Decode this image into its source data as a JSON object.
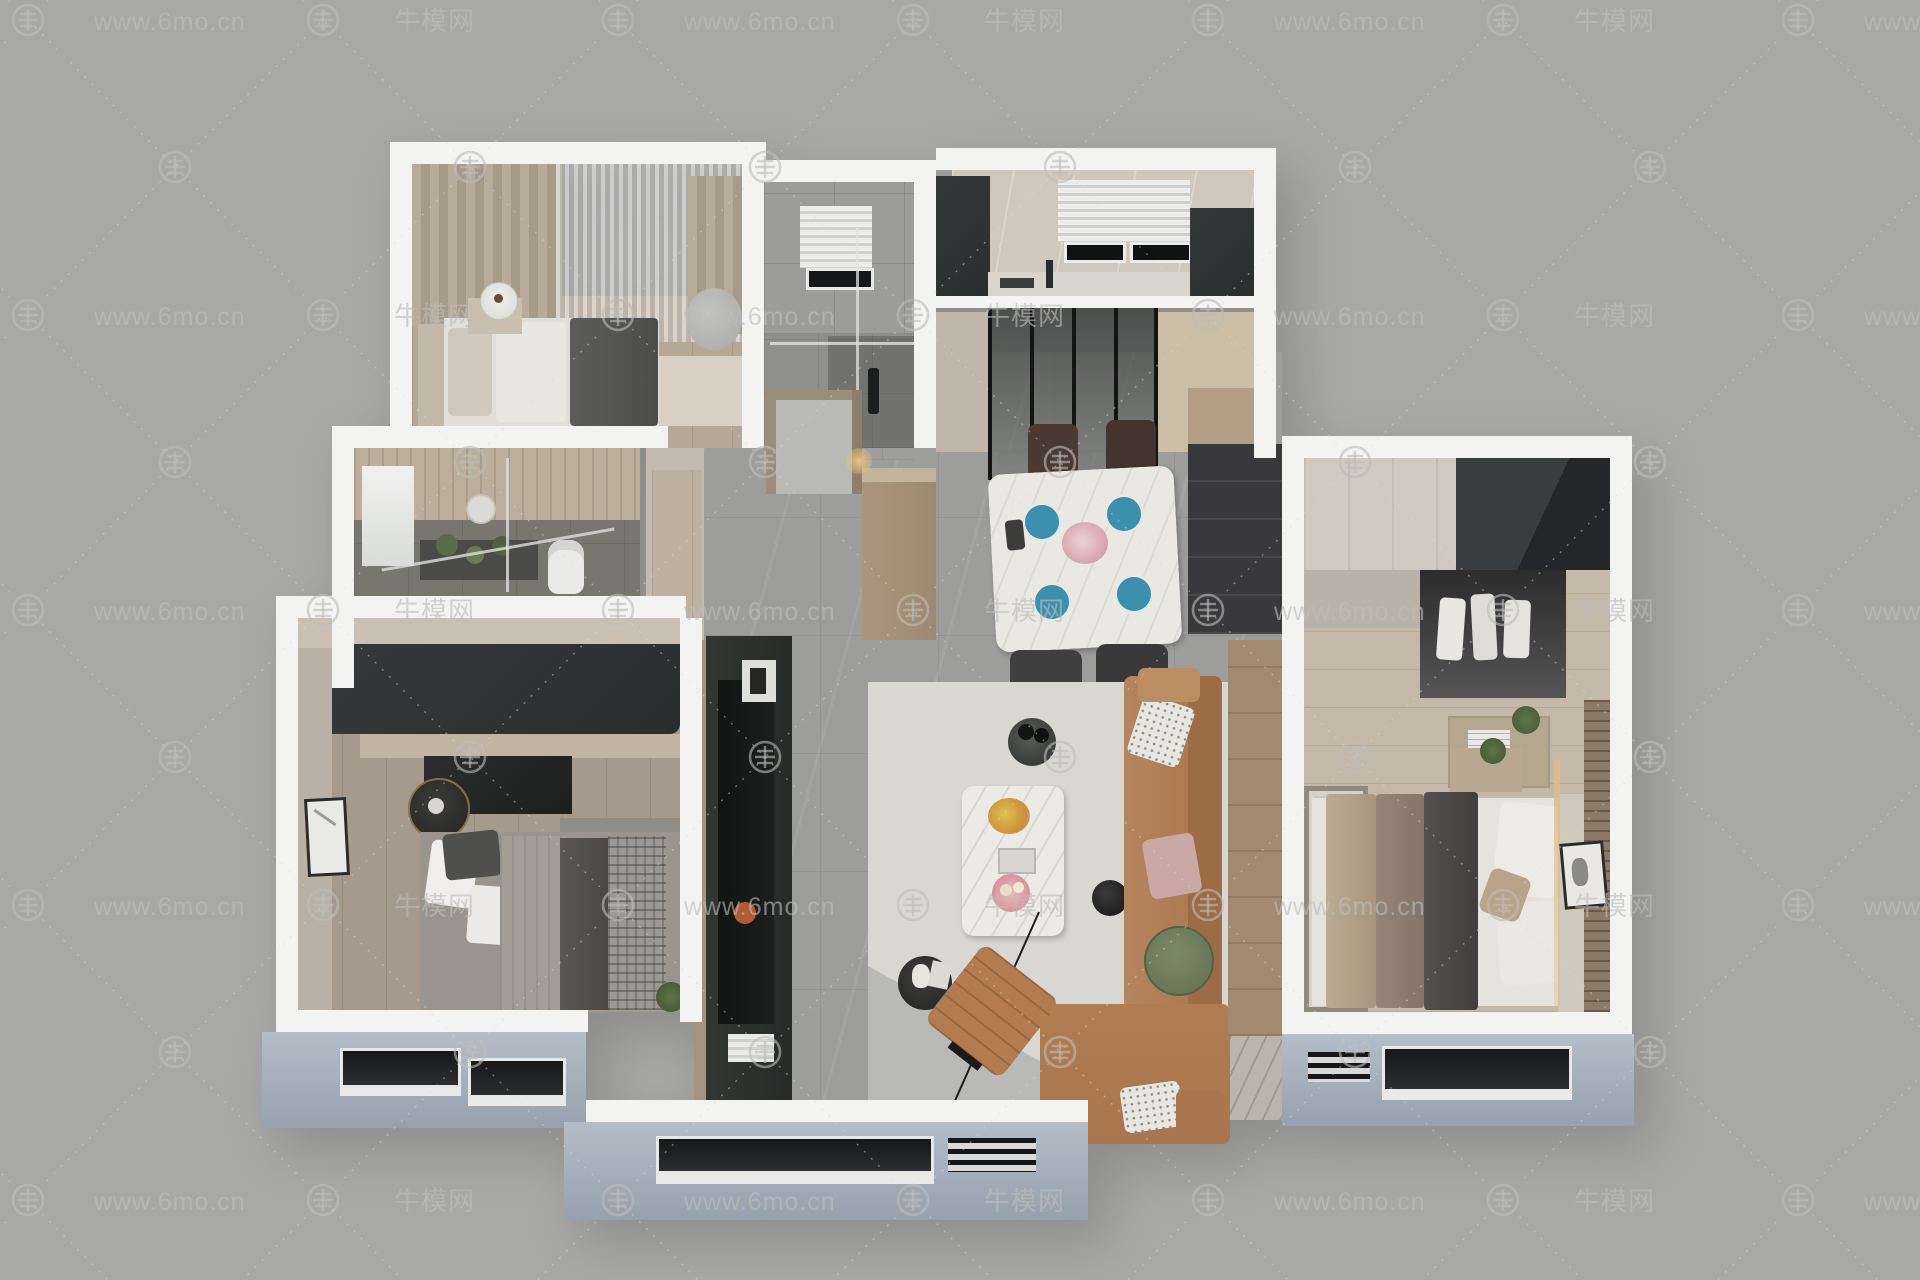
{
  "watermark": {
    "site_text": "www.6mo.cn",
    "brand_text": "牛模网",
    "logo": "niumo-circle-logo"
  },
  "scene": {
    "type": "3d-floorplan-top-view-render",
    "rooms_visible": [
      "bedroom-top-left",
      "bathroom-top-middle",
      "kitchen-top-right",
      "dining-area",
      "entry-hall",
      "bathroom-left-middle",
      "bedroom-bottom-left",
      "living-room",
      "bedroom-right"
    ]
  },
  "colors": {
    "background": "#a8a9a7",
    "wall_cut_white": "#f3f4f2",
    "exterior_face_blue_gray": "#a7b0bc",
    "floor_tile_gray": "#9d9e9c",
    "floor_wood": "#b6a896",
    "sofa_tan": "#ad7a52",
    "wardrobe_charcoal": "#3a3d3e",
    "dining_table_marble": "#eae8e3",
    "plate_teal": "#3d8fae",
    "side_table_green": "#6d7b5c",
    "coffee_plate_pink": "#d9939c",
    "flower_yellow": "#d8b13a"
  }
}
